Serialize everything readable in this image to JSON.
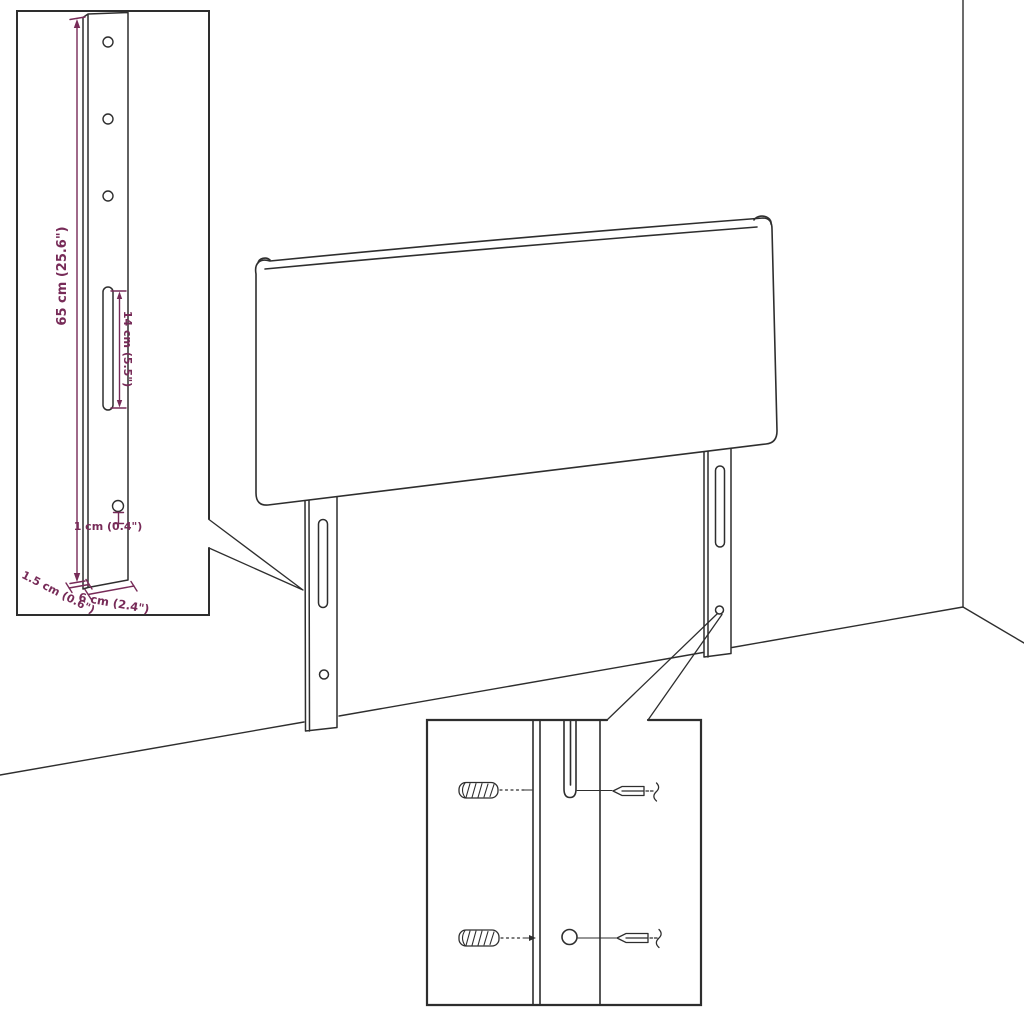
{
  "colors": {
    "line": "#2e2e2e",
    "dimension": "#772b58",
    "background": "#ffffff"
  },
  "bracket_inset": {
    "height_label": "65 cm (25.6\")",
    "slot_label": "14 cm (5.5\")",
    "hole_label": "1 cm (0.4\")",
    "thickness_label": "1.5 cm (0.6\")",
    "width_label": "6 cm (2.4\")"
  }
}
